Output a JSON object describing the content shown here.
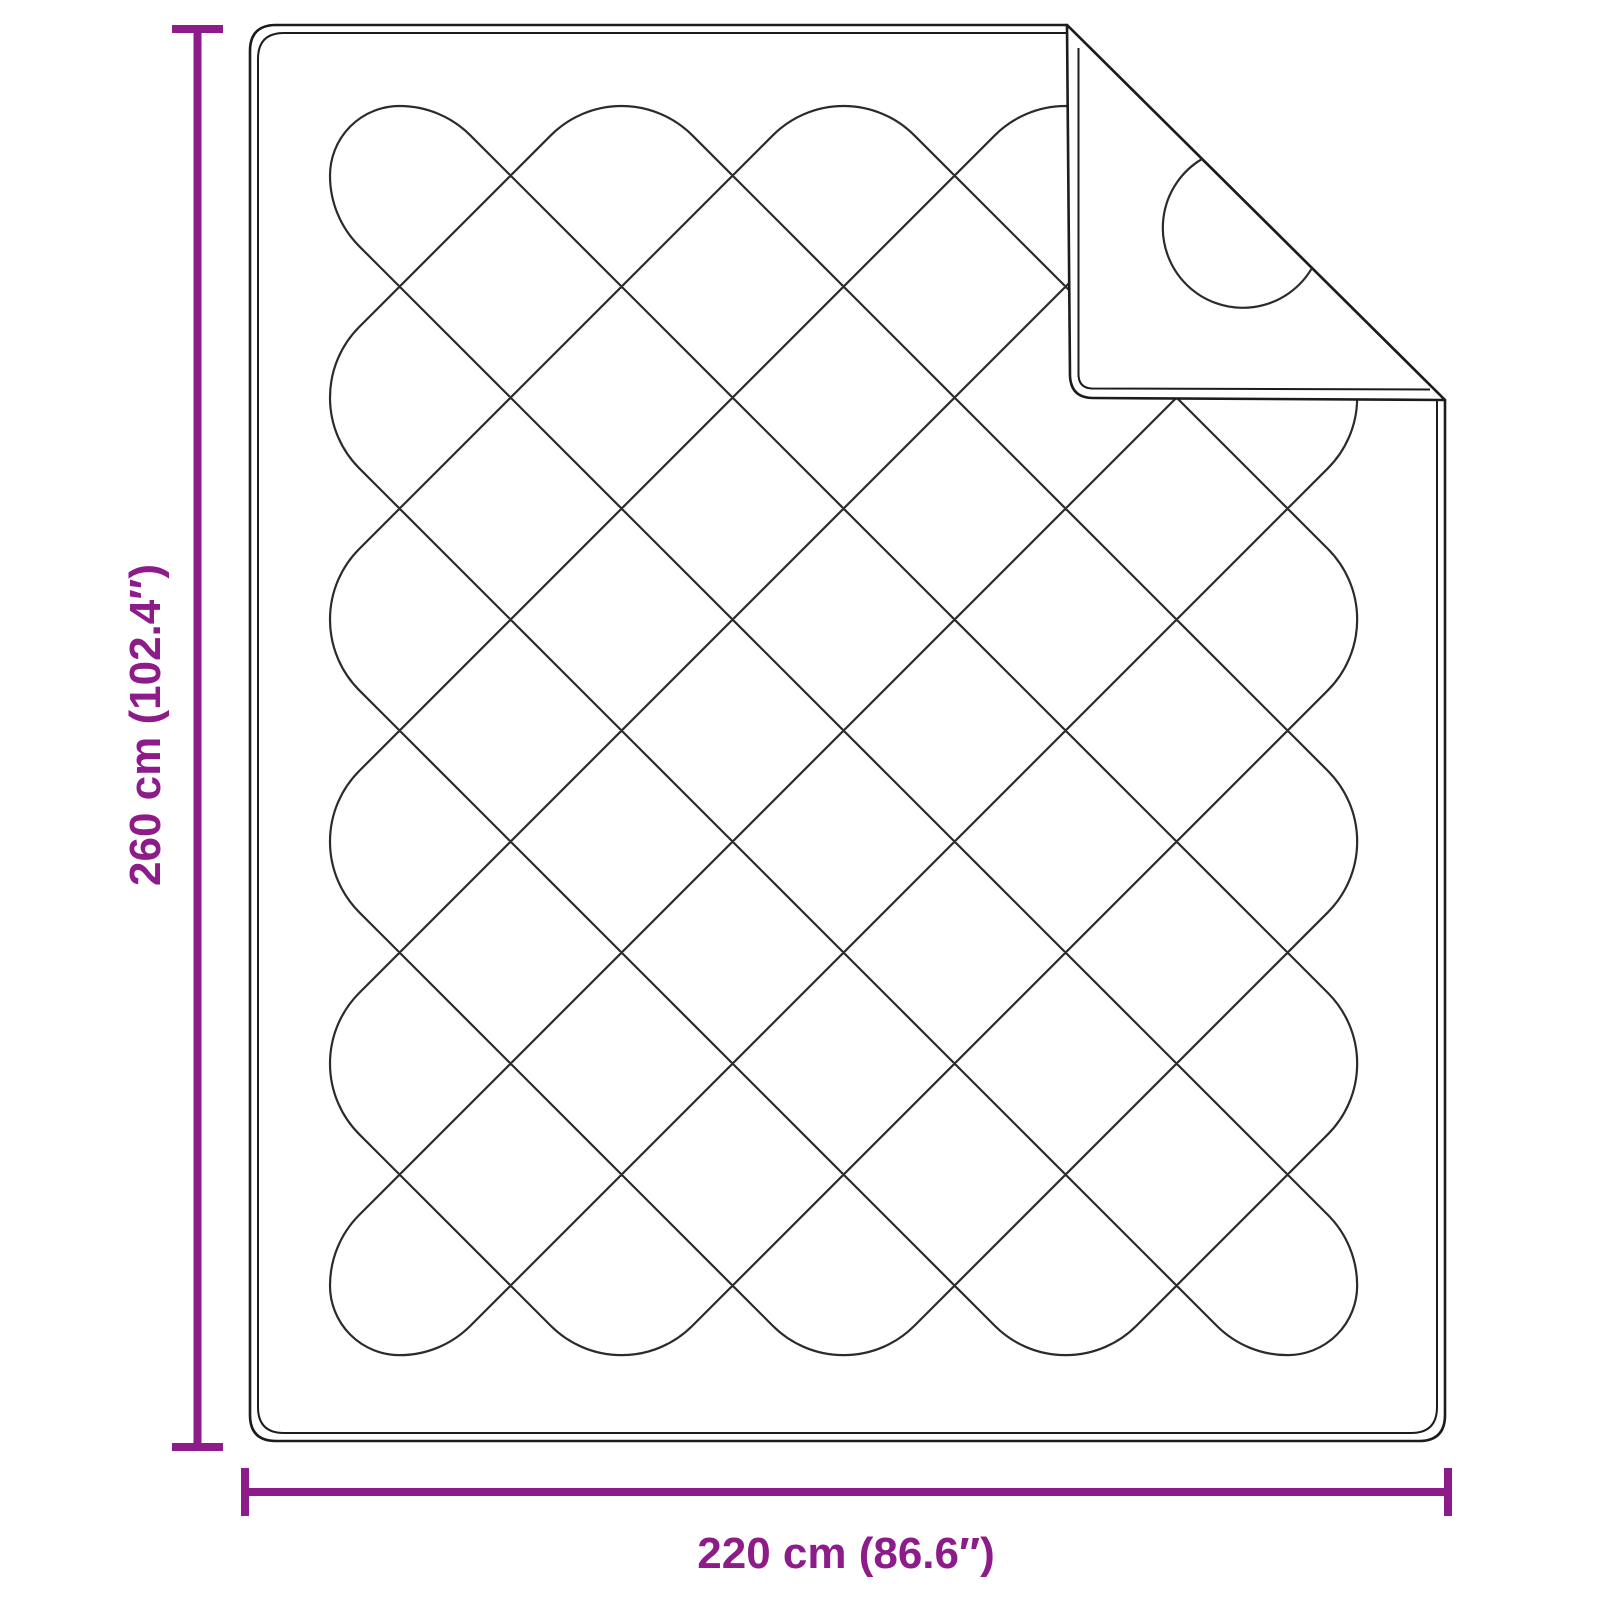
{
  "dimensions": {
    "height_label": "260 cm (102.4″)",
    "width_label": "220 cm (86.6″)",
    "height_cm": 260,
    "width_cm": 220,
    "height_in": 102.4,
    "width_in": 86.6
  },
  "colors": {
    "accent": "#8D1C8A",
    "outline": "#1C1C1C",
    "pattern_line": "#2B2B2B",
    "background": "#FFFFFF"
  }
}
